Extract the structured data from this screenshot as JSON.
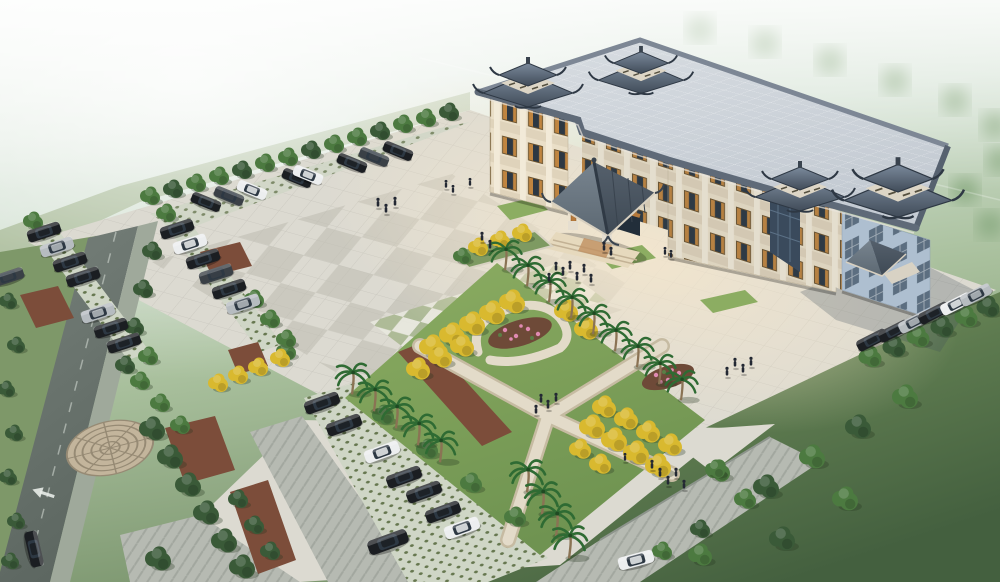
{
  "image": {
    "type": "aerial-architectural-rendering",
    "subject": "Chinese-style civic building with traditional tiled roofs, entrance canopy, paved plaza, landscaped gardens with palm and ginkgo trees, parking lots and perimeter roads seen from a bird's-eye view in morning mist",
    "width": 1000,
    "height": 582
  },
  "palette": {
    "fog1": "#eef4ee",
    "fog2": "#d3e1d3",
    "fog3": "#a9c09d",
    "fog4": "#7d9770",
    "grass1": "#8aa468",
    "grass2": "#5d7a4f",
    "grass3": "#44603f",
    "pavement": "#dcdad1",
    "warm": "#f7e8cd",
    "checker": "#c4c1b4",
    "green_tile": "#a9b791",
    "white_tile": "#e8e8de",
    "lattice_bg": "#cfd6c6",
    "lattice_dot": "#66774f",
    "herring_bg": "#b6bab2",
    "herring_line": "#a2a79f",
    "asphalt": "#6b756f",
    "roof_slab1": "#d8dde2",
    "roof_slab2": "#c3cad2",
    "china1": "#7b8a9c",
    "china2": "#414c59",
    "facade": "#eadfc8",
    "pilaster": "#f2ead8",
    "spandrel": "#dfd3bb",
    "shutter": "#c08540",
    "glass": "#2d3843",
    "side_face": "#aebfd0",
    "side_win": "#5c6e80",
    "wood": "#b5793c",
    "lawn1": "#8cad62",
    "lawn2": "#6f9351",
    "mulch": "#7c4d3a",
    "path": "#e3dbc9",
    "path_edge": "#c6bba2",
    "mosaic_base": "#c3b59c",
    "mosaic_ring": "#968a74",
    "tree_green": "#4c7a40",
    "tree_dark": "#3a5a38",
    "tree_yellow": "#d9b92f",
    "tree_olive": "#7c9b52",
    "palm": "#2f6b33",
    "trunk": "#8a7354",
    "car_black": "#1b1e22",
    "car_white": "#eceeef",
    "car_silver": "#b6bcc0",
    "car_gray": "#3a4046",
    "people_dark": "#232833",
    "flower_pink": "#e08ab2"
  },
  "scene": {
    "building": {
      "style": "chinese-traditional",
      "floors_visible": 3,
      "rooftop_pavilions": 4,
      "entrance_canopy": "gabled dark-tile roof on timber columns with steps",
      "window_shutters": "orange lattice",
      "side_entrance_canopy": true
    },
    "plaza": {
      "checkerboard_paving": true,
      "green_white_tile_band": true,
      "lawn_insets": 3,
      "raised_planter_with_yellow_trees": true
    },
    "garden": {
      "crossing_paths": "X-shaped mosaic walkways",
      "flower_beds": 2,
      "mulch_beds": true
    },
    "vegetation": {
      "palm_trees": 18,
      "yellow_trees": 27,
      "green_trees_bushes": 68,
      "distant_tree_clusters": 9
    },
    "vehicles": {
      "cars_total": 38,
      "colors": [
        "black",
        "white",
        "silver",
        "dark-gray"
      ]
    },
    "people_total": 33,
    "roads": {
      "left_road_with_arrow_marking": true,
      "bottom_herringbone_road": true,
      "circular_mosaic_plaza": true
    }
  }
}
